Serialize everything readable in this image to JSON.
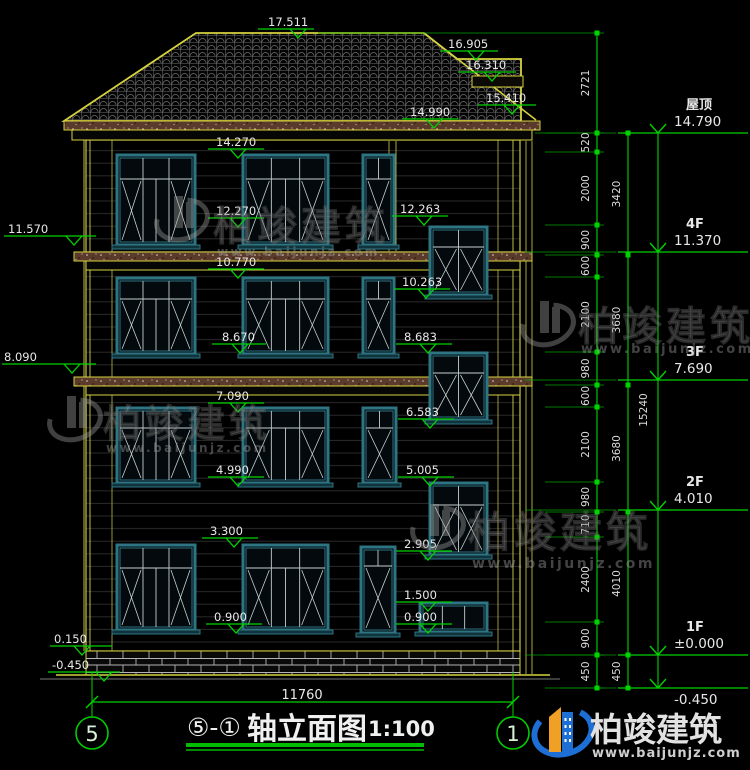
{
  "drawing_title": {
    "axes": "⑤-①",
    "name": "轴立面图",
    "scale": "1:100"
  },
  "axis_bubbles": {
    "left": "5",
    "right": "1"
  },
  "bottom_dim": "11760",
  "facade_marks": [
    "17.511",
    "16.905",
    "16.310",
    "15.410",
    "14.990",
    "14.270",
    "12.270",
    "12.263",
    "10.770",
    "10.263",
    "8.670",
    "8.683",
    "7.090",
    "6.583",
    "4.990",
    "5.005",
    "3.300",
    "2.905",
    "1.500",
    "0.900",
    "0.900"
  ],
  "left_marks": [
    "11.570",
    "8.090",
    "0.150",
    "-0.450"
  ],
  "levels": [
    {
      "name": "屋顶",
      "value": "14.790"
    },
    {
      "name": "4F",
      "value": "11.370"
    },
    {
      "name": "3F",
      "value": "7.690"
    },
    {
      "name": "2F",
      "value": "4.010"
    },
    {
      "name": "1F",
      "value": "±0.000"
    },
    {
      "name": "",
      "value": "-0.450"
    }
  ],
  "dim_chain_inner": [
    "2721",
    "520",
    "2000",
    "900",
    "600",
    "2100",
    "980",
    "600",
    "2100",
    "980",
    "710",
    "2400",
    "900",
    "450"
  ],
  "dim_chain_mid": [
    "3420",
    "3680",
    "3680",
    "4010",
    "450"
  ],
  "dim_total": "15240",
  "watermark": {
    "brand": "柏竣建筑",
    "url": "www.baijunjz.com"
  },
  "colors": {
    "annotation_green": "#00d400",
    "outline_yellow": "#d4d04a",
    "window_teal": "#2e7583",
    "text_white": "#e8e8e8",
    "logo_blue": "#1d6fd6",
    "logo_orange": "#f0a125"
  }
}
